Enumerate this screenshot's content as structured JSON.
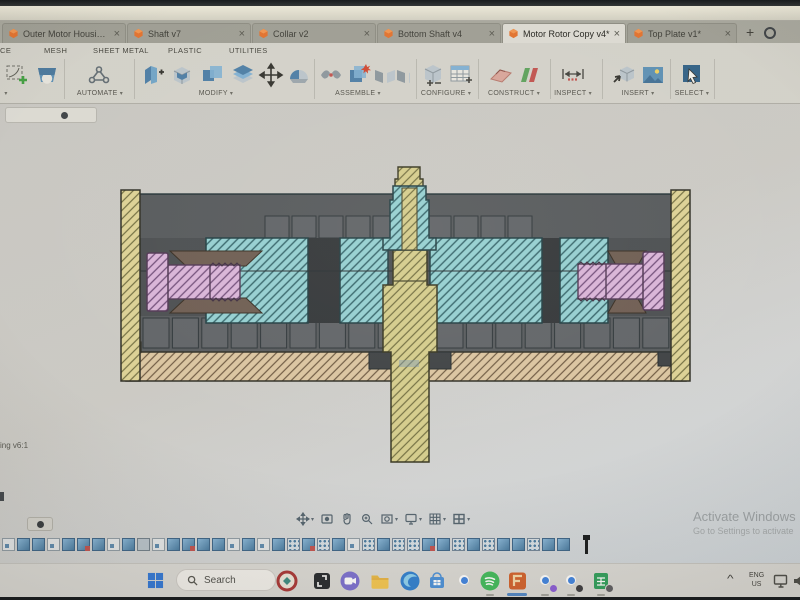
{
  "window": {
    "tabs": [
      {
        "label": "Outer Motor Housing v6",
        "active": false
      },
      {
        "label": "Shaft v7",
        "active": false
      },
      {
        "label": "Collar v2",
        "active": false
      },
      {
        "label": "Bottom Shaft v4",
        "active": false
      },
      {
        "label": "Motor Rotor Copy v4*",
        "active": true
      },
      {
        "label": "Top Plate v1*",
        "active": false
      }
    ],
    "new_tab_label": "+"
  },
  "icons": {
    "caret": "▾",
    "close": "×",
    "chevron_up": "^"
  },
  "menubar": {
    "items": [
      "SURFACE",
      "MESH",
      "SHEET METAL",
      "PLASTIC",
      "UTILITIES"
    ]
  },
  "ribbon": {
    "groups": [
      "AUTOMATE",
      "MODIFY",
      "ASSEMBLE",
      "CONFIGURE",
      "CONSTRUCT",
      "INSPECT",
      "INSERT",
      "SELECT"
    ]
  },
  "canvas": {
    "browser_root_label": "ing v6:1",
    "section_view_colors": {
      "rotor_teal": "#93d0d3",
      "clamp_bolt_pink": "#d9b4da",
      "shaft_khaki": "#d5cd8c",
      "housing_wall_yellow": "#ddd295",
      "base_plate_tan": "#dbc5a1",
      "unsectioned_gray": "#474b4f",
      "outline_ink": "#203036"
    },
    "nav_toolbar": [
      "pan-icon",
      "orbit-icon",
      "hand-icon",
      "zoom-icon",
      "fit-icon",
      "display-settings-icon",
      "grid-icon",
      "viewports-icon"
    ],
    "timeline": {
      "features": [
        "sketch",
        "extrude",
        "extrude",
        "sketch",
        "extrude",
        "edit",
        "extrude",
        "sketch",
        "extrude",
        "component",
        "sketch",
        "extrude",
        "edit",
        "extrude",
        "extrude",
        "sketch",
        "extrude",
        "sketch",
        "extrude",
        "pattern",
        "edit",
        "pattern",
        "extrude",
        "sketch",
        "pattern",
        "extrude",
        "pattern",
        "pattern",
        "edit",
        "extrude",
        "pattern",
        "extrude",
        "pattern",
        "extrude",
        "extrude",
        "pattern",
        "extrude",
        "extrude"
      ]
    }
  },
  "watermark": {
    "line1": "Activate Windows",
    "line2": "Go to Settings to activate"
  },
  "taskbar": {
    "search_placeholder": "Search",
    "apps": [
      "start",
      "school-logo",
      "capture",
      "chat",
      "file-explorer",
      "edge",
      "microsoft-store",
      "chrome",
      "spotify",
      "fusion-360",
      "chrome-profile-2",
      "chrome-profile-3",
      "sheets"
    ],
    "tray": {
      "language_line1": "ENG",
      "language_line2": "US"
    }
  }
}
